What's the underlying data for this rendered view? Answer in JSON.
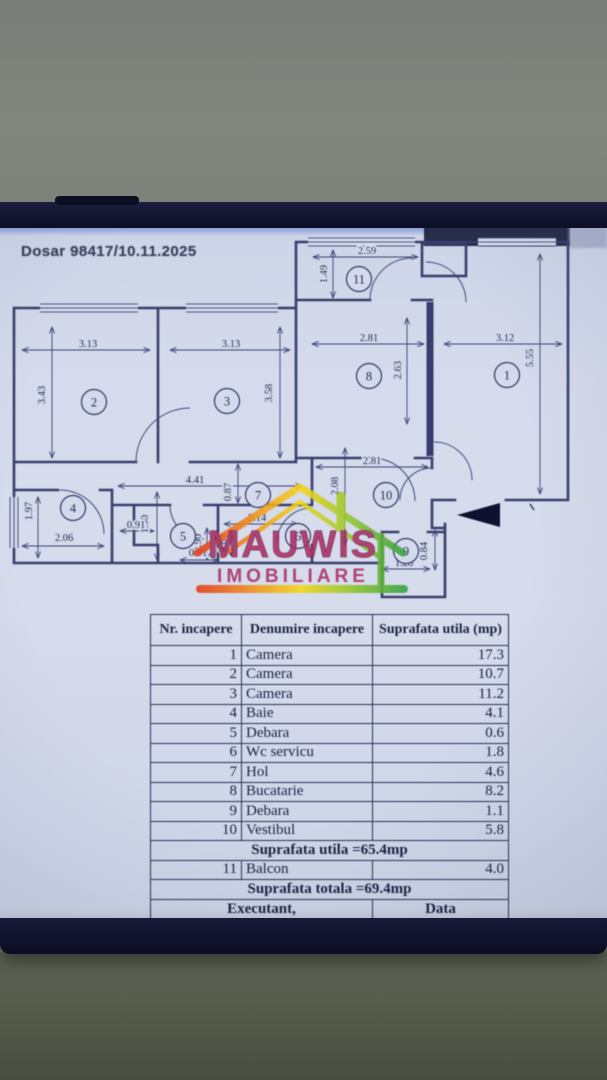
{
  "document": {
    "file_label": "Dosar 98417/10.11.2025"
  },
  "plan": {
    "rooms": [
      {
        "n": "1",
        "x": 507,
        "y": 375
      },
      {
        "n": "2",
        "x": 94,
        "y": 402
      },
      {
        "n": "3",
        "x": 227,
        "y": 401
      },
      {
        "n": "4",
        "x": 73,
        "y": 508
      },
      {
        "n": "5",
        "x": 183,
        "y": 536
      },
      {
        "n": "6",
        "x": 298,
        "y": 536
      },
      {
        "n": "7",
        "x": 258,
        "y": 495
      },
      {
        "n": "8",
        "x": 369,
        "y": 376
      },
      {
        "n": "9",
        "x": 406,
        "y": 551
      },
      {
        "n": "10",
        "x": 386,
        "y": 495
      },
      {
        "n": "11",
        "x": 359,
        "y": 279
      }
    ],
    "dims": [
      {
        "v": "2.59",
        "x": 367,
        "y": 254,
        "r": 0
      },
      {
        "v": "1.49",
        "x": 327,
        "y": 274,
        "r": -90
      },
      {
        "v": "3.13",
        "x": 88,
        "y": 347,
        "r": 0
      },
      {
        "v": "3.43",
        "x": 45,
        "y": 395,
        "r": -90
      },
      {
        "v": "3.13",
        "x": 231,
        "y": 347,
        "r": 0
      },
      {
        "v": "3.58",
        "x": 272,
        "y": 393,
        "r": -90
      },
      {
        "v": "2.81",
        "x": 369,
        "y": 341,
        "r": 0
      },
      {
        "v": "2.63",
        "x": 401,
        "y": 370,
        "r": -90
      },
      {
        "v": "3.12",
        "x": 505,
        "y": 341,
        "r": 0
      },
      {
        "v": "5.55",
        "x": 533,
        "y": 358,
        "r": -90
      },
      {
        "v": "4.41",
        "x": 195,
        "y": 483,
        "r": 0
      },
      {
        "v": "0.87",
        "x": 231,
        "y": 492,
        "r": -90
      },
      {
        "v": "2.81",
        "x": 372,
        "y": 464,
        "r": 0
      },
      {
        "v": "2.08",
        "x": 338,
        "y": 486,
        "r": -90
      },
      {
        "v": "1.90",
        "x": 148,
        "y": 524,
        "r": -90
      },
      {
        "v": "0.91",
        "x": 136,
        "y": 528,
        "r": 0
      },
      {
        "v": "2.14",
        "x": 257,
        "y": 521,
        "r": 0
      },
      {
        "v": "0.90",
        "x": 201,
        "y": 543,
        "r": -90
      },
      {
        "v": "0.89",
        "x": 226,
        "y": 543,
        "r": -90
      },
      {
        "v": "1.97",
        "x": 32,
        "y": 511,
        "r": -90
      },
      {
        "v": "2.06",
        "x": 64,
        "y": 541,
        "r": 0
      },
      {
        "v": "0.91",
        "x": 198,
        "y": 556,
        "r": 0
      },
      {
        "v": "1.28",
        "x": 404,
        "y": 566,
        "r": 0
      },
      {
        "v": "0.84",
        "x": 427,
        "y": 551,
        "r": -90
      }
    ]
  },
  "watermark": {
    "title": "MAUWIS",
    "subtitle": "IMOBILIARE",
    "accent_magenta": "#aa2e63",
    "roof_red": "#e63c1a",
    "roof_yellow": "#f4d616",
    "roof_green": "#35a23f"
  },
  "table": {
    "headers": [
      "Nr. incapere",
      "Denumire incapere",
      "Suprafata utila (mp)"
    ],
    "rows": [
      [
        "1",
        "Camera",
        "17.3"
      ],
      [
        "2",
        "Camera",
        "10.7"
      ],
      [
        "3",
        "Camera",
        "11.2"
      ],
      [
        "4",
        "Baie",
        "4.1"
      ],
      [
        "5",
        "Debara",
        "0.6"
      ],
      [
        "6",
        "Wc servicu",
        "1.8"
      ],
      [
        "7",
        "Hol",
        "4.6"
      ],
      [
        "8",
        "Bucatarie",
        "8.2"
      ],
      [
        "9",
        "Debara",
        "1.1"
      ],
      [
        "10",
        "Vestibul",
        "5.8"
      ]
    ],
    "subtotal_label": "Suprafata utila =65.4mp",
    "balcony_row": [
      "11",
      "Balcon",
      "4.0"
    ],
    "total_label": "Suprafata totala =69.4mp",
    "footer": [
      "Executant,",
      "Data"
    ]
  }
}
